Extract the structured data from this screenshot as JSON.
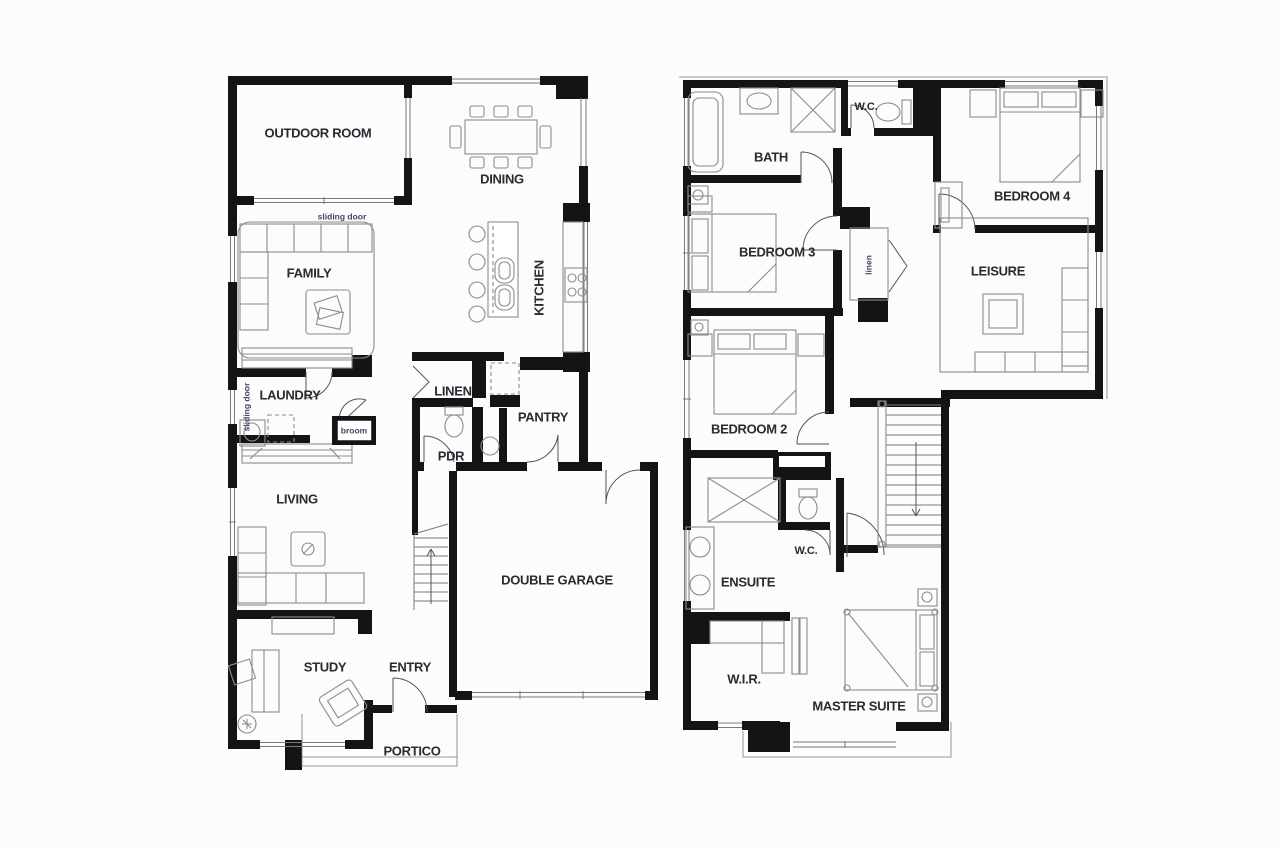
{
  "colors": {
    "background": "#fcfcfc",
    "wall": "#141416",
    "furniture_line": "#8c8c8c",
    "window_line": "#7a7a7a",
    "door_line": "#555555",
    "label": "#2a2a33",
    "small_label": "#4b3e60"
  },
  "labels": {
    "ground": {
      "outdoor_room": "OUTDOOR ROOM",
      "dining": "DINING",
      "sliding_door_top": "sliding door",
      "family": "FAMILY",
      "kitchen": "KITCHEN",
      "laundry": "LAUNDRY",
      "sliding_door_side": "sliding door",
      "broom": "broom",
      "linen": "LINEN",
      "pantry": "PANTRY",
      "pdr": "PDR",
      "living": "LIVING",
      "double_garage": "DOUBLE GARAGE",
      "study": "STUDY",
      "entry": "ENTRY",
      "portico": "PORTICO"
    },
    "upper": {
      "bath": "BATH",
      "wc_upper": "W.C.",
      "bedroom4": "BEDROOM 4",
      "bedroom3": "BEDROOM 3",
      "linen": "linen",
      "leisure": "LEISURE",
      "bedroom2": "BEDROOM 2",
      "ensuite": "ENSUITE",
      "wc_ensuite": "W.C.",
      "wir": "W.I.R.",
      "master_suite": "MASTER SUITE"
    }
  }
}
